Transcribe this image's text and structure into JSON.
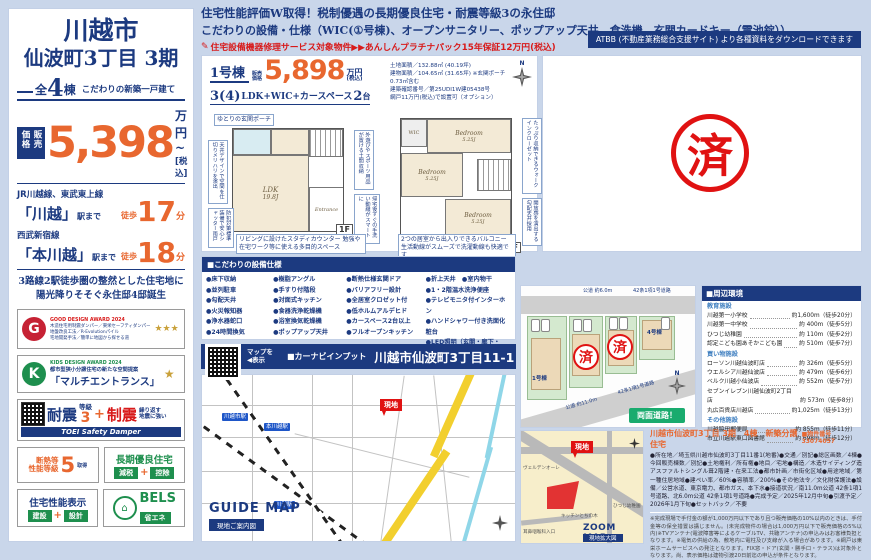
{
  "sidebar": {
    "city": "川越市",
    "project": "仙波町3丁目 3期",
    "count_prefix": "全",
    "count": "4",
    "count_suffix": "棟",
    "tagline": "こだわりの新築一戸建て",
    "price_label": "販売価格",
    "price": "5,398",
    "price_unit": "万円~",
    "price_tax": "[税込]",
    "access": [
      {
        "line": "JR川越線、東武東上線",
        "station": "「川越」",
        "to": "駅まで",
        "walk": "徒歩",
        "min": "17",
        "unit": "分"
      },
      {
        "line": "西武新宿線",
        "station": "「本川越」",
        "to": "駅まで",
        "walk": "徒歩",
        "min": "18",
        "unit": "分"
      }
    ],
    "catch1": "3路線2駅徒歩圏の整然とした住宅地に",
    "catch2": "陽光降りそそぐ永住邸4邸誕生",
    "good_design": {
      "logo": "G",
      "award": "GOOD DESIGN AWARD 2024",
      "l1": "木造住宅用制震ダンパー／東栄セーフティダンパー",
      "l2": "地盤改良工法／R-Evolutionパイル",
      "l3": "宅地開発手法／簡単に地図から探せる道",
      "stars": "★★★"
    },
    "kids_design": {
      "logo": "K",
      "award": "KIDS DESIGN AWARD 2024",
      "l1": "都市型狭小分譲住宅の新たな空間提案",
      "l2": "「マルチエントランス」",
      "stars": "★"
    },
    "taishin": {
      "t1": "耐震",
      "t2": "等級",
      "t3": "3",
      "plus": "+",
      "s1": "制震",
      "s2": "繰り返す",
      "s3": "地震に強い",
      "bar": "TOEI Safety Damper"
    },
    "dannetsu": {
      "l1": "断熱等",
      "l2": "性能等級",
      "num": "5",
      "get": "取得"
    },
    "choki": {
      "title": "長期優良住宅",
      "b1": "減税",
      "plus": "+",
      "b2": "控除"
    },
    "hyoji": {
      "title": "住宅性能表示",
      "b1": "建設",
      "plus": "+",
      "b2": "設計"
    },
    "bels": {
      "title": "BELS",
      "badge": "省エネ"
    }
  },
  "header": {
    "line1": "住宅性能評価W取得！税制優遇の長期優良住宅・耐震等級3の永住邸",
    "line2": "こだわりの設備・仕様（WIC(①号棟)、オープンサニタリー、ポップアップ天井、食洗機、玄関カードキー（電池錠））",
    "line3": "住宅設備機器修理サービス対象物件▶▶あんしんプラチナパック15年保証12万円(税込)",
    "atbb": "ATBB (不動産業務総合支援サイト) より各種資料をダウンロードできます"
  },
  "icons": {
    "pencil": "✎"
  },
  "floorplan": {
    "unit": "1号棟",
    "price_label_1": "販売",
    "price_label_2": "価格",
    "price": "5,898",
    "price_unit_1": "万円",
    "price_unit_2": "(税込)",
    "plan_a": "3(4)",
    "plan_b": "LDK+WIC+カースペース",
    "plan_c": "2",
    "plan_d": "台",
    "land": "土地面積／132.88㎡ (40.19坪)",
    "building": "建物面積／104.65㎡ (31.65坪) ※玄関ポーチ0.73㎡含む",
    "kakunin": "建築確認番号／第25UDI1W建05438号",
    "amido": "網戸11万円(税込)で設置可（オプション）",
    "f1": "1F",
    "f2": "2F",
    "ldk": "LDK",
    "ldk_size": "19.8J",
    "entrance": "Entrance",
    "bedroom": "Bedroom",
    "b_size": "5.25J",
    "wic": "WIC",
    "balcony": "Balcony",
    "compass_n": "N",
    "callout_porch": "ゆとりの玄関ポーチ",
    "callout_study": "リビングに設けたスタディカウンター 勉強や在宅ワーク等に使える多目的スペース",
    "callout_balcony": "2つの居室から出入りできるバルコニー 生活動線がスムーズで洗濯動線も快適です",
    "v1": "天井デザインで空間を仕切りメリハリを演出",
    "v2": "防犯対策標準装備で安心シャッター雨戸",
    "v3": "外遊びやスポーツ用品が置ける土間収納",
    "v4": "帰宅後すぐの手洗い動線がスマートに",
    "v5": "たっぷり収納できるウォークインクローゼット",
    "v6": "開放感を演出する勾配天井採用"
  },
  "stamp": "済",
  "equipment": {
    "title": "■こだわりの設備仕様",
    "col1": [
      "●床下収納",
      "●並列駐車",
      "●勾配天井",
      "●火災報知器",
      "●浄水器蛇口",
      "●24時間換気"
    ],
    "col2": [
      "●樹脂アングル",
      "●手すり付階段",
      "●対面式キッチン",
      "●食器洗浄乾燥機",
      "●浴室換気乾燥機",
      "●ポップアップ天井"
    ],
    "col3": [
      "●断熱仕様玄関ドア",
      "●バリアフリー設計",
      "●全居室クロゼット付",
      "●低ホルムアルデヒド",
      "●カースペース2台以上",
      "●フルオープンキッチン"
    ],
    "col4": [
      "●折上天井　●室内物干",
      "●1・2階温水洗浄便座",
      "●テレビモニタ付インターホン",
      "●ハンドシャワー付き洗面化粧台",
      "●LED照明（玄関・廊下・",
      "　キッチン・トイレ・洗面所）"
    ]
  },
  "carnavi": {
    "qr1": "マップを",
    "qr2": "◀表示",
    "label": "■カーナビインプット",
    "address": "川越市仙波町3丁目11-1"
  },
  "guide_map": {
    "title": "GUIDE MAP",
    "subtitle": "現地ご案内図",
    "marker": "現地",
    "station1": "川越市駅",
    "station2": "本川越駅",
    "station3": "川越駅"
  },
  "site_plan": {
    "road_top": "公道 約6.0m",
    "road_top_name": "42条1項1号道路",
    "road_left": "公道 約11.0m",
    "road_left_name": "42条1項1号道路",
    "lot1": "1号棟",
    "lot4": "4号棟",
    "sold": "済",
    "badge": "両面道路！",
    "compass_n": "N"
  },
  "environment": {
    "title": "■周辺環境",
    "groups": [
      {
        "name": "教育施設",
        "items": [
          {
            "n": "川越第一小学校",
            "d": "約1,600m（徒歩20分）"
          },
          {
            "n": "川越第一中学校",
            "d": "約 400m（徒歩5分）"
          },
          {
            "n": "ひつじ幼稚園",
            "d": "約 110m（徒歩2分）"
          },
          {
            "n": "認定こども園あそかこども園",
            "d": "約 510m（徒歩7分）"
          }
        ]
      },
      {
        "name": "買い物施設",
        "items": [
          {
            "n": "ローソン川越仙波町店",
            "d": "約 326m（徒歩5分）"
          },
          {
            "n": "ウエルシア川越仙波店",
            "d": "約 479m（徒歩6分）"
          },
          {
            "n": "ベルク川越小仙波店",
            "d": "約 552m（徒歩7分）"
          },
          {
            "n": "セブンイレブン川越仙波町2丁目店",
            "d": "約 573m（徒歩8分）"
          },
          {
            "n": "丸広百貨店川越店",
            "d": "約1,025m（徒歩13分）"
          }
        ]
      },
      {
        "name": "その他施設",
        "items": [
          {
            "n": "川越脇田郵便局",
            "d": "約 855m（徒歩11分）"
          },
          {
            "n": "市立川越駅東口図書館",
            "d": "約 698m（徒歩12分）"
          }
        ]
      }
    ]
  },
  "zoom_map": {
    "title": "ZOOM MAP",
    "subtitle": "現地拡大図",
    "marker": "現地",
    "poi1": "ヴェルデンオーレ",
    "poi2": "キッチンとちの木",
    "poi3": "ひつじ幼稚園",
    "poi4": "耳鼻咽喉科入口"
  },
  "overview": {
    "title": "川越市仙波町3丁目 3期　4棟　新築分譲住宅",
    "number": "■物件番号 33074057",
    "body": "●所在地／埼玉県川越市仙波町3丁目11番1(地番)●交通／別記●総区画数／4棟●今回販売棟数／別記●土地権利／所有権●地目／宅地●構造／木造サイディング造アスファルトシングル葺2階建・在来工法●都市計画／市街化区域●用途地域／第一種住居地域●建ぺい率／60%●容積率／200%●その他法令／文化財保護法●設備／公営水道、東京電力、都市ガス、本下水●接道状況／南11.0m公道 42条1項1号道路、北6.0m公道 42条1項1号道路●完成予定／2025年12月中旬●引渡予定／2026年1月下旬●セットバック／不要",
    "disclaimer": "※完成現場で手付金の額が1,000万円以下であり且つ販売価格の10%以内のときは、手付金等の保全措置は講じません。(未完成物件の場合は1,000万円以下で販売価格の5%以内)※TVアンテナ(電波障害等によるケーブルTV、共聴アンテナ)の申込みはお客様負担となります。※電気の供給の為、敷地内に電柱及び支線が入る場合があります。※網戸は東栄ホームサービスへの発注となります。FIX窓・ドア(玄関・勝手口・テラス)は対象外となります。尚、表示価格は建物引渡20日前迄の申込が条件となります。"
  }
}
